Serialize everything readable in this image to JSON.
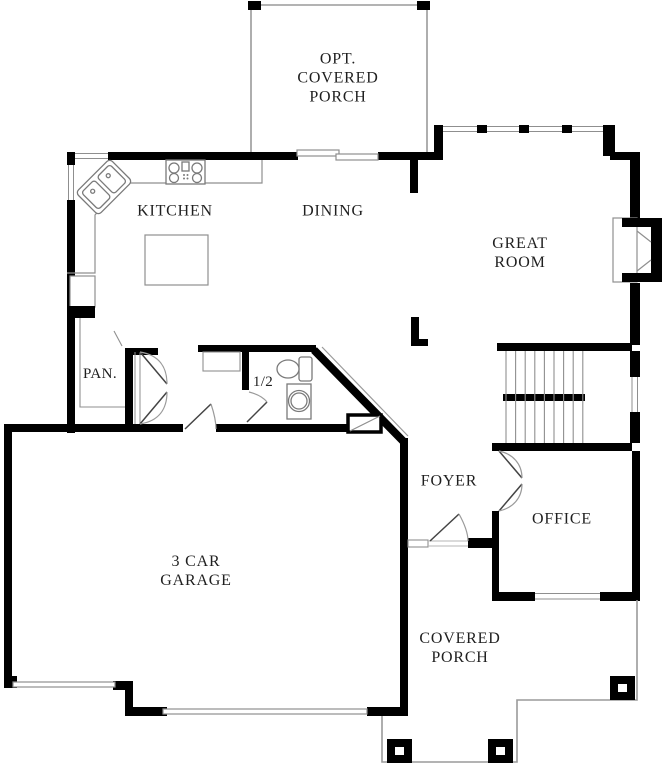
{
  "plan_title": "First floor plan",
  "rooms": [
    {
      "name": "opt-covered-porch",
      "label": "OPT.\nCOVERED\nPORCH"
    },
    {
      "name": "kitchen",
      "label": "KITCHEN"
    },
    {
      "name": "dining",
      "label": "DINING"
    },
    {
      "name": "great-room",
      "label": "GREAT\nROOM"
    },
    {
      "name": "pantry",
      "label": "PAN."
    },
    {
      "name": "half-bath",
      "label": "1/2"
    },
    {
      "name": "foyer",
      "label": "FOYER"
    },
    {
      "name": "office",
      "label": "OFFICE"
    },
    {
      "name": "garage",
      "label": "3 CAR\nGARAGE"
    },
    {
      "name": "covered-porch",
      "label": "COVERED\nPORCH"
    }
  ],
  "fixtures": [
    "corner-sink",
    "cooktop",
    "kitchen-island",
    "refrigerator",
    "pantry-shelves",
    "closet-double-doors",
    "toilet",
    "pedestal-sink",
    "stairs",
    "fireplace",
    "sliding-glass-door",
    "single-garage-door",
    "double-garage-door",
    "front-door",
    "office-double-doors",
    "porch-posts",
    "windows"
  ],
  "colors": {
    "wall": "#000000",
    "thin_line": "#8f8f8f",
    "text": "#1f1f1f",
    "background": "#ffffff"
  }
}
